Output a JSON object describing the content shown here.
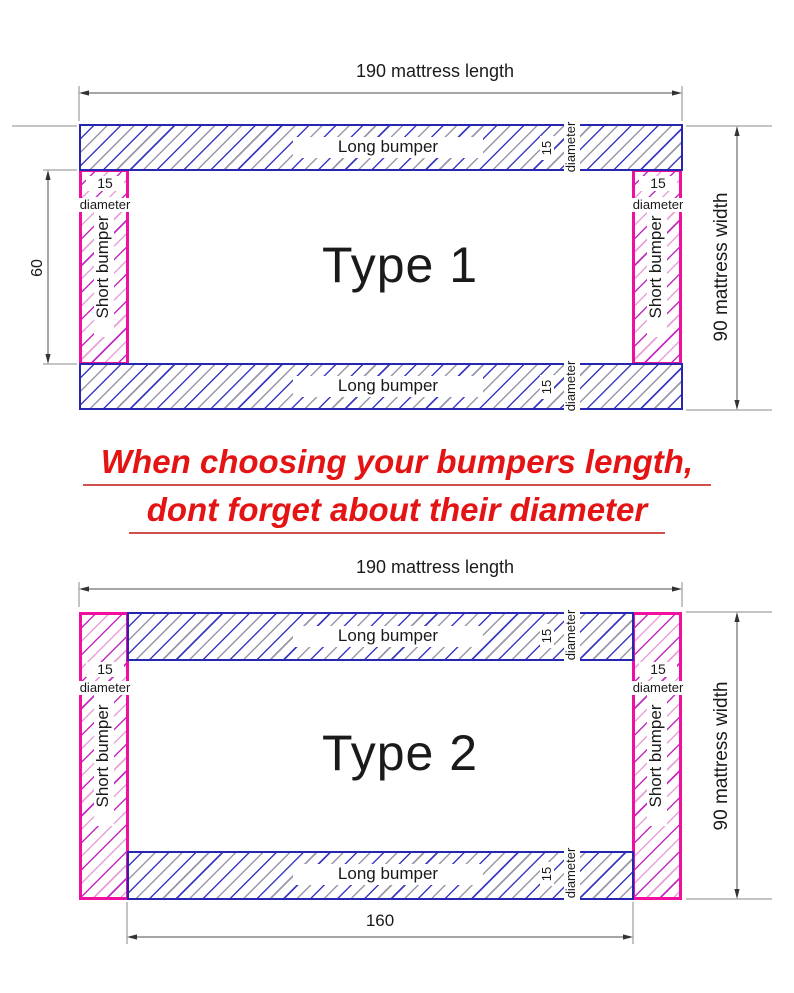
{
  "shared": {
    "long_bumper": "Long bumper",
    "short_bumper": "Short bumper",
    "diameter_value": "15",
    "diameter_word": "diameter"
  },
  "type1": {
    "title": "Type 1",
    "length_dim": "190 mattress length",
    "width_dim": "90 mattress width",
    "short_bumper_length": "60"
  },
  "type2": {
    "title": "Type 2",
    "length_dim": "190 mattress length",
    "width_dim": "90 mattress width",
    "long_bumper_length": "160"
  },
  "warning": {
    "line1": "When choosing your bumpers length,",
    "line2": "dont forget about their diameter"
  },
  "colors": {
    "long_border": "#2626b0",
    "long_hatch_blue": "#3c3cc2",
    "long_hatch_gray": "#9898a8",
    "short_border": "#f00f9e",
    "short_hatch_magenta": "#c32cc3",
    "short_hatch_pink": "#e8a0d8",
    "dim_line": "#4d4d4d",
    "ext_line": "#8a8a8a",
    "warning_red": "#e41414"
  }
}
